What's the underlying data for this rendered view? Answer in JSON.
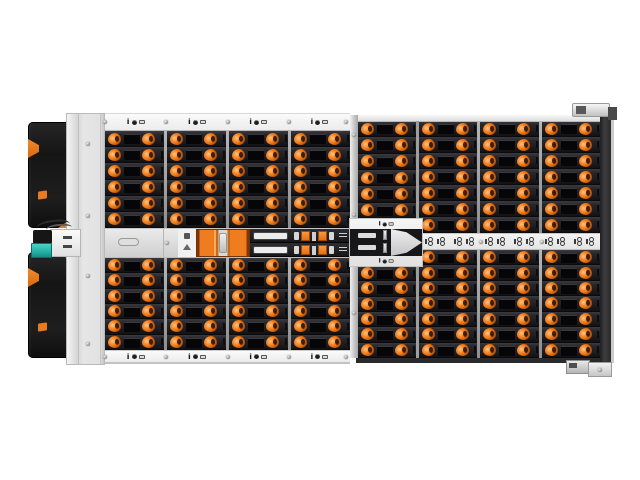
{
  "scene": {
    "type": "product-photograph",
    "subject": "High-density rackmount storage enclosure (JBOD), top-front view, fully populated with orange-latch drive carriers",
    "background": "#ffffff"
  },
  "colors": {
    "latch_orange": "#e8700f",
    "accent_orange": "#e87a1f",
    "teal": "#2ab7ad",
    "bay_dark": "#202024",
    "bay_label_black": "#060608",
    "chassis_silver": "#e3e3e3",
    "strip_light": "#f0f0f0",
    "ear_black": "#1b1b1b",
    "edge_dark": "#333336",
    "iom_black": "#17171a",
    "divider_gray": "#9e9e9e"
  },
  "enclosure": {
    "legend": {
      "info_glyph": "i"
    },
    "sections": {
      "left_top": {
        "groups": 4,
        "rows": 6
      },
      "left_bottom": {
        "groups": 4,
        "rows": 6
      },
      "rightA_top": {
        "groups": 1,
        "rows": 6
      },
      "rightA_bottom": {
        "groups": 1,
        "rows": 6
      },
      "rightBCD_top": {
        "groups": 3,
        "rows": 7
      },
      "rightBCD_bottom": {
        "groups": 3,
        "rows": 7
      }
    },
    "legend_strips": {
      "top_left_slots": 4,
      "bottom_left_slots": 4,
      "trapezoid_labels": 2
    },
    "status_strip": {
      "groups": 3,
      "icon_pairs_per_group": 2
    },
    "io_modules": {
      "rows": 2,
      "orange_clips_per_row": 2
    },
    "fan_module": {
      "orange_bars": 2
    }
  }
}
